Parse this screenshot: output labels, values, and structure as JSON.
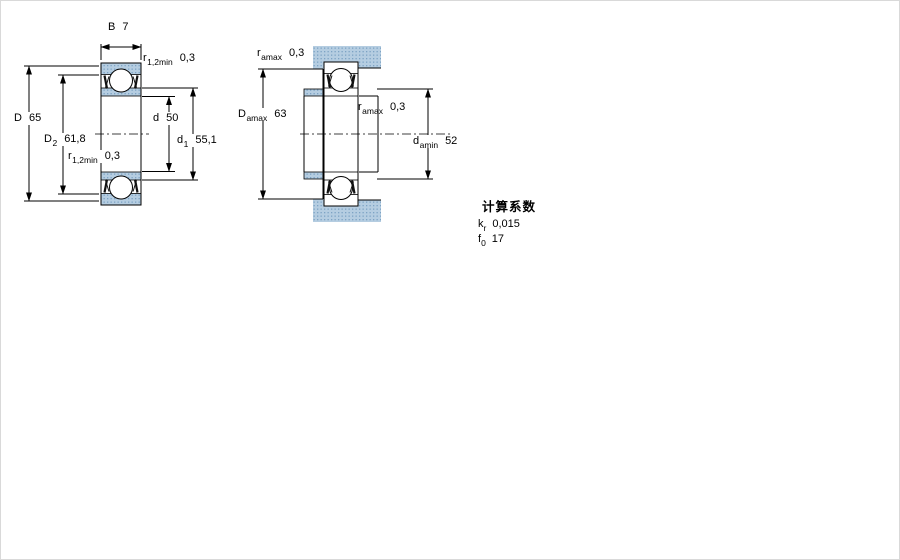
{
  "figure": {
    "type": "bearing technical drawing",
    "views": [
      "bearing cross-section with dimensions",
      "abutment and fillet dimensions"
    ]
  },
  "colors": {
    "section_fill": "#b5cde1",
    "section_dot": "#7da3c4",
    "line": "#000000",
    "background": "#ffffff"
  },
  "left_drawing": {
    "dims": {
      "B": {
        "sym": "B",
        "sub": "",
        "value": "7"
      },
      "D": {
        "sym": "D",
        "sub": "",
        "value": "65"
      },
      "D2": {
        "sym": "D",
        "sub": "2",
        "value": "61,8"
      },
      "d": {
        "sym": "d",
        "sub": "",
        "value": "50"
      },
      "d1": {
        "sym": "d",
        "sub": "1",
        "value": "55,1"
      },
      "r12_top": {
        "sym": "r",
        "sub": "1,2min",
        "value": "0,3"
      },
      "r12_bottom": {
        "sym": "r",
        "sub": "1,2min",
        "value": "0,3"
      }
    }
  },
  "right_drawing": {
    "dims": {
      "ramax_top": {
        "sym": "r",
        "sub": "amax",
        "value": "0,3"
      },
      "ramax_mid": {
        "sym": "r",
        "sub": "amax",
        "value": "0,3"
      },
      "Damax": {
        "sym": "D",
        "sub": "amax",
        "value": "63"
      },
      "damin": {
        "sym": "d",
        "sub": "amin",
        "value": "52"
      }
    }
  },
  "calculation_factors": {
    "title": "计算系数",
    "items": [
      {
        "sym": "k",
        "sub": "r",
        "value": "0,015"
      },
      {
        "sym": "f",
        "sub": "0",
        "value": "17"
      }
    ]
  }
}
